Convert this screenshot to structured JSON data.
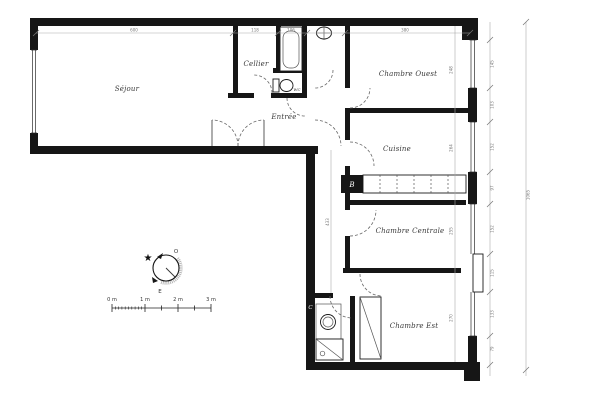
{
  "rooms": [
    {
      "label": "Séjour"
    },
    {
      "label": "Cellier"
    },
    {
      "label": "WC"
    },
    {
      "label": "Entrée"
    },
    {
      "label": "Chambre Ouest"
    },
    {
      "label": "Cuisine"
    },
    {
      "label": "Chambre Centrale"
    },
    {
      "label": "Chambre Est"
    }
  ],
  "markers": {
    "duct_b": "B",
    "duct_c": "C"
  },
  "compass": {
    "west_label": "O",
    "east_label": "E",
    "star": "★"
  },
  "scale_bar": {
    "labels": [
      "0 m",
      "1 m",
      "2 m",
      "3 m"
    ]
  },
  "dimensions": {
    "top": [
      "600",
      "118",
      "106",
      "380"
    ],
    "right_segments": [
      "145",
      "103",
      "152",
      "97",
      "152",
      "115",
      "133",
      "79"
    ],
    "right_overall": "1065",
    "room_depths": [
      "248",
      "264",
      "255",
      "270"
    ],
    "corridor": "433"
  },
  "colors": {
    "wall": "#161616",
    "dim_line": "#aaaaaa",
    "background": "#ffffff"
  }
}
